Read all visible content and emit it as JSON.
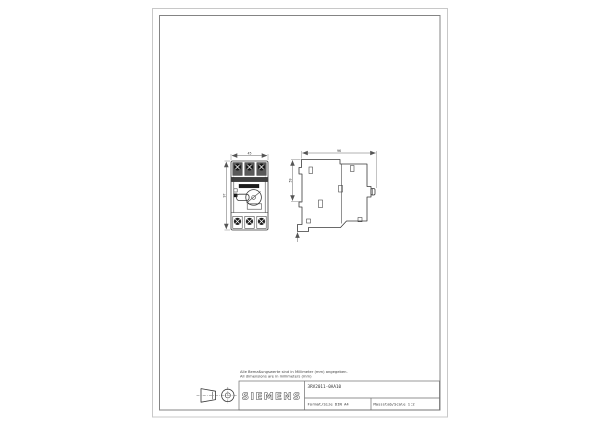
{
  "title_block": {
    "brand": "SIEMENS",
    "part_number": "3RV2011-0AA10",
    "format": "Format/Size DIN A4",
    "scale": "Massstab/Scale 1:2"
  },
  "notes": {
    "line1": "Alle Bemaßungswerte sind in Millimeter (mm) angegeben.",
    "line2": "All dimensions are in millimeters (mm)"
  },
  "dimensions": {
    "front_width": "45",
    "front_height": "97",
    "side_depth": "96",
    "side_upper": "59"
  },
  "symbols": {
    "projection": "first-angle-projection-symbol"
  },
  "colors": {
    "paper": "#ffffff",
    "sheet_edge": "#c8c8c8",
    "frame": "#848484",
    "line": "#3a3a3a",
    "dim": "#555555",
    "dark_fill": "#1c1c1c"
  }
}
